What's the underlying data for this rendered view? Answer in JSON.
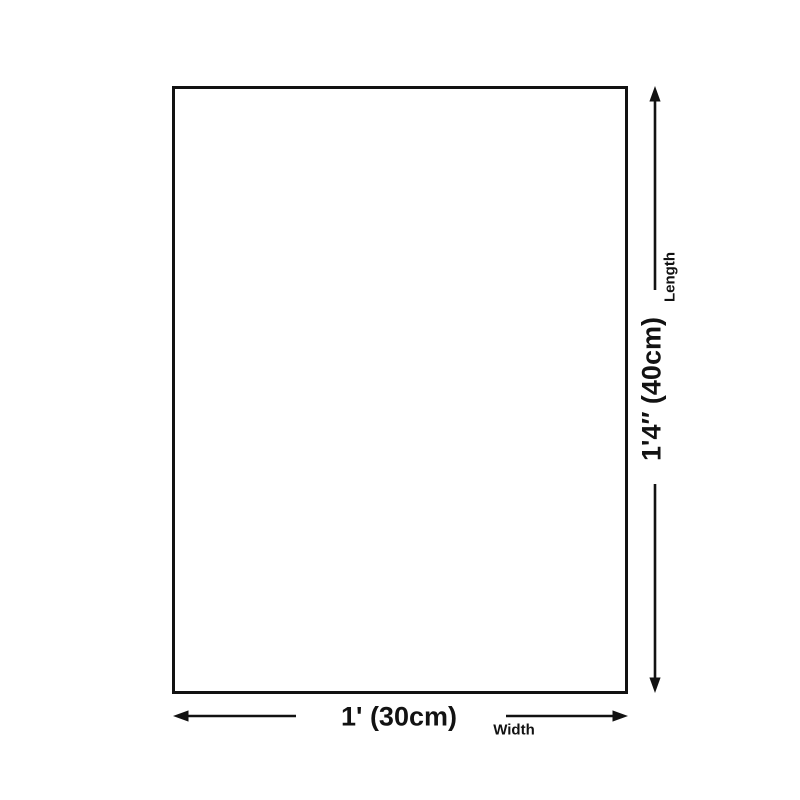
{
  "diagram": {
    "length": {
      "value": "1'4″ (40cm)",
      "label": "Length"
    },
    "width": {
      "value": "1' (30cm)",
      "label": "Width"
    },
    "colors": {
      "line": "#121212",
      "background": "#ffffff"
    }
  }
}
